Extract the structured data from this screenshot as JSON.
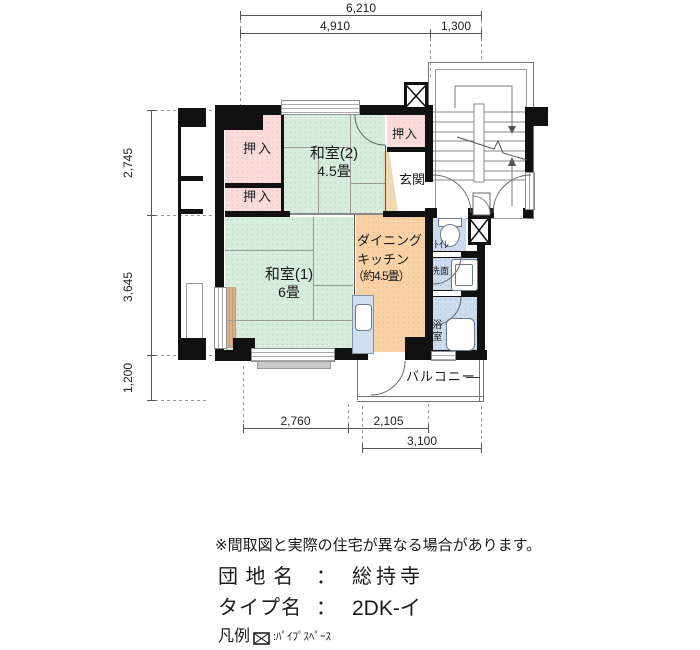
{
  "dimensions": {
    "top_total": "6,210",
    "top_main": "4,910",
    "top_stair": "1,300",
    "left_upper": "2,745",
    "left_middle": "3,645",
    "left_lower": "1,200",
    "bottom_left": "2,760",
    "bottom_mid": "2,105",
    "bottom_right": "3,100"
  },
  "rooms": {
    "washitsu2_name": "和室(2)",
    "washitsu2_size": "4.5畳",
    "washitsu1_name": "和室(1)",
    "washitsu1_size": "6畳",
    "dk_line1": "ダイニング・",
    "dk_line2": "キッチン",
    "dk_line3": "（約4.5畳）",
    "genkan": "玄関",
    "closet_upper_left": "押入",
    "closet_lower_left": "押入",
    "closet_right": "押入",
    "toilet": "ﾄｲﾚ",
    "washroom": "洗面",
    "bath": "浴室",
    "balcony": "バルコニー"
  },
  "footer": {
    "disclaimer": "※間取図と実際の住宅が異なる場合があります。",
    "estate_label": "団 地 名",
    "estate_colon": "：",
    "estate_value": "総持寺",
    "type_label": "タイプ名",
    "type_colon": "：",
    "type_value": "2DK-イ",
    "legend_label": "凡例",
    "legend_text": ":ﾊﾟｲﾌﾟｽﾍﾟｰｽ"
  },
  "colors": {
    "tatami_green": "#d8ecdc",
    "closet_pink": "#f9dcda",
    "kitchen_orange": "#f7d2a6",
    "wet_area_blue": "#cddbef",
    "wall_black": "#111111"
  }
}
